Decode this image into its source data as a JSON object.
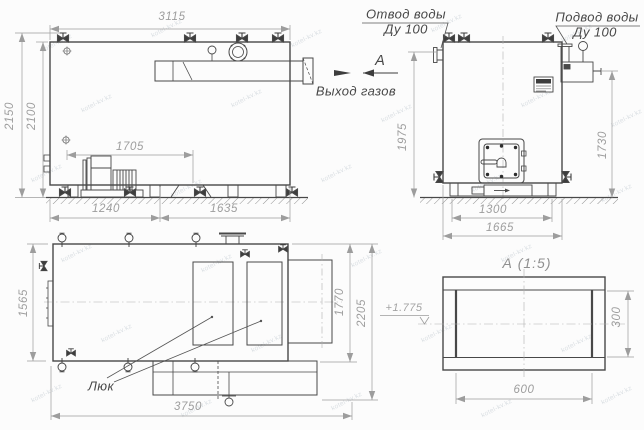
{
  "drawing": {
    "watermark": {
      "text": "kotel-kv.kz"
    },
    "colors": {
      "line": "#484848",
      "dim": "#9d9d9d",
      "label": "#474747",
      "background": "#fcfcfc"
    },
    "views": {
      "side": {
        "dims": {
          "overall_length": "3115",
          "overall_height": "2150",
          "body_height": "2100",
          "fan_assembly": "1705",
          "base_front": "1240",
          "base_rear": "1635"
        }
      },
      "front": {
        "labels": {
          "water_outlet": "Отвод воды",
          "water_outlet_dn": "Ду 100",
          "water_inlet": "Подвод воды",
          "water_inlet_dn": "Ду 100",
          "gas_exit": "Выход газов",
          "section_arrow": "А"
        },
        "dims": {
          "height_to_outlet": "1975",
          "height_to_inlet": "1730",
          "base_width": "1300",
          "overall_width": "1665"
        }
      },
      "plan": {
        "labels": {
          "hatch": "Люк"
        },
        "dims": {
          "width": "1565",
          "overall_length": "3750",
          "flue_length": "1770",
          "overall_length_with_flue": "2205"
        }
      },
      "detail": {
        "title": "А  (1:5)",
        "elevation": "+1.775",
        "dims": {
          "height": "300",
          "width": "600"
        }
      }
    }
  }
}
